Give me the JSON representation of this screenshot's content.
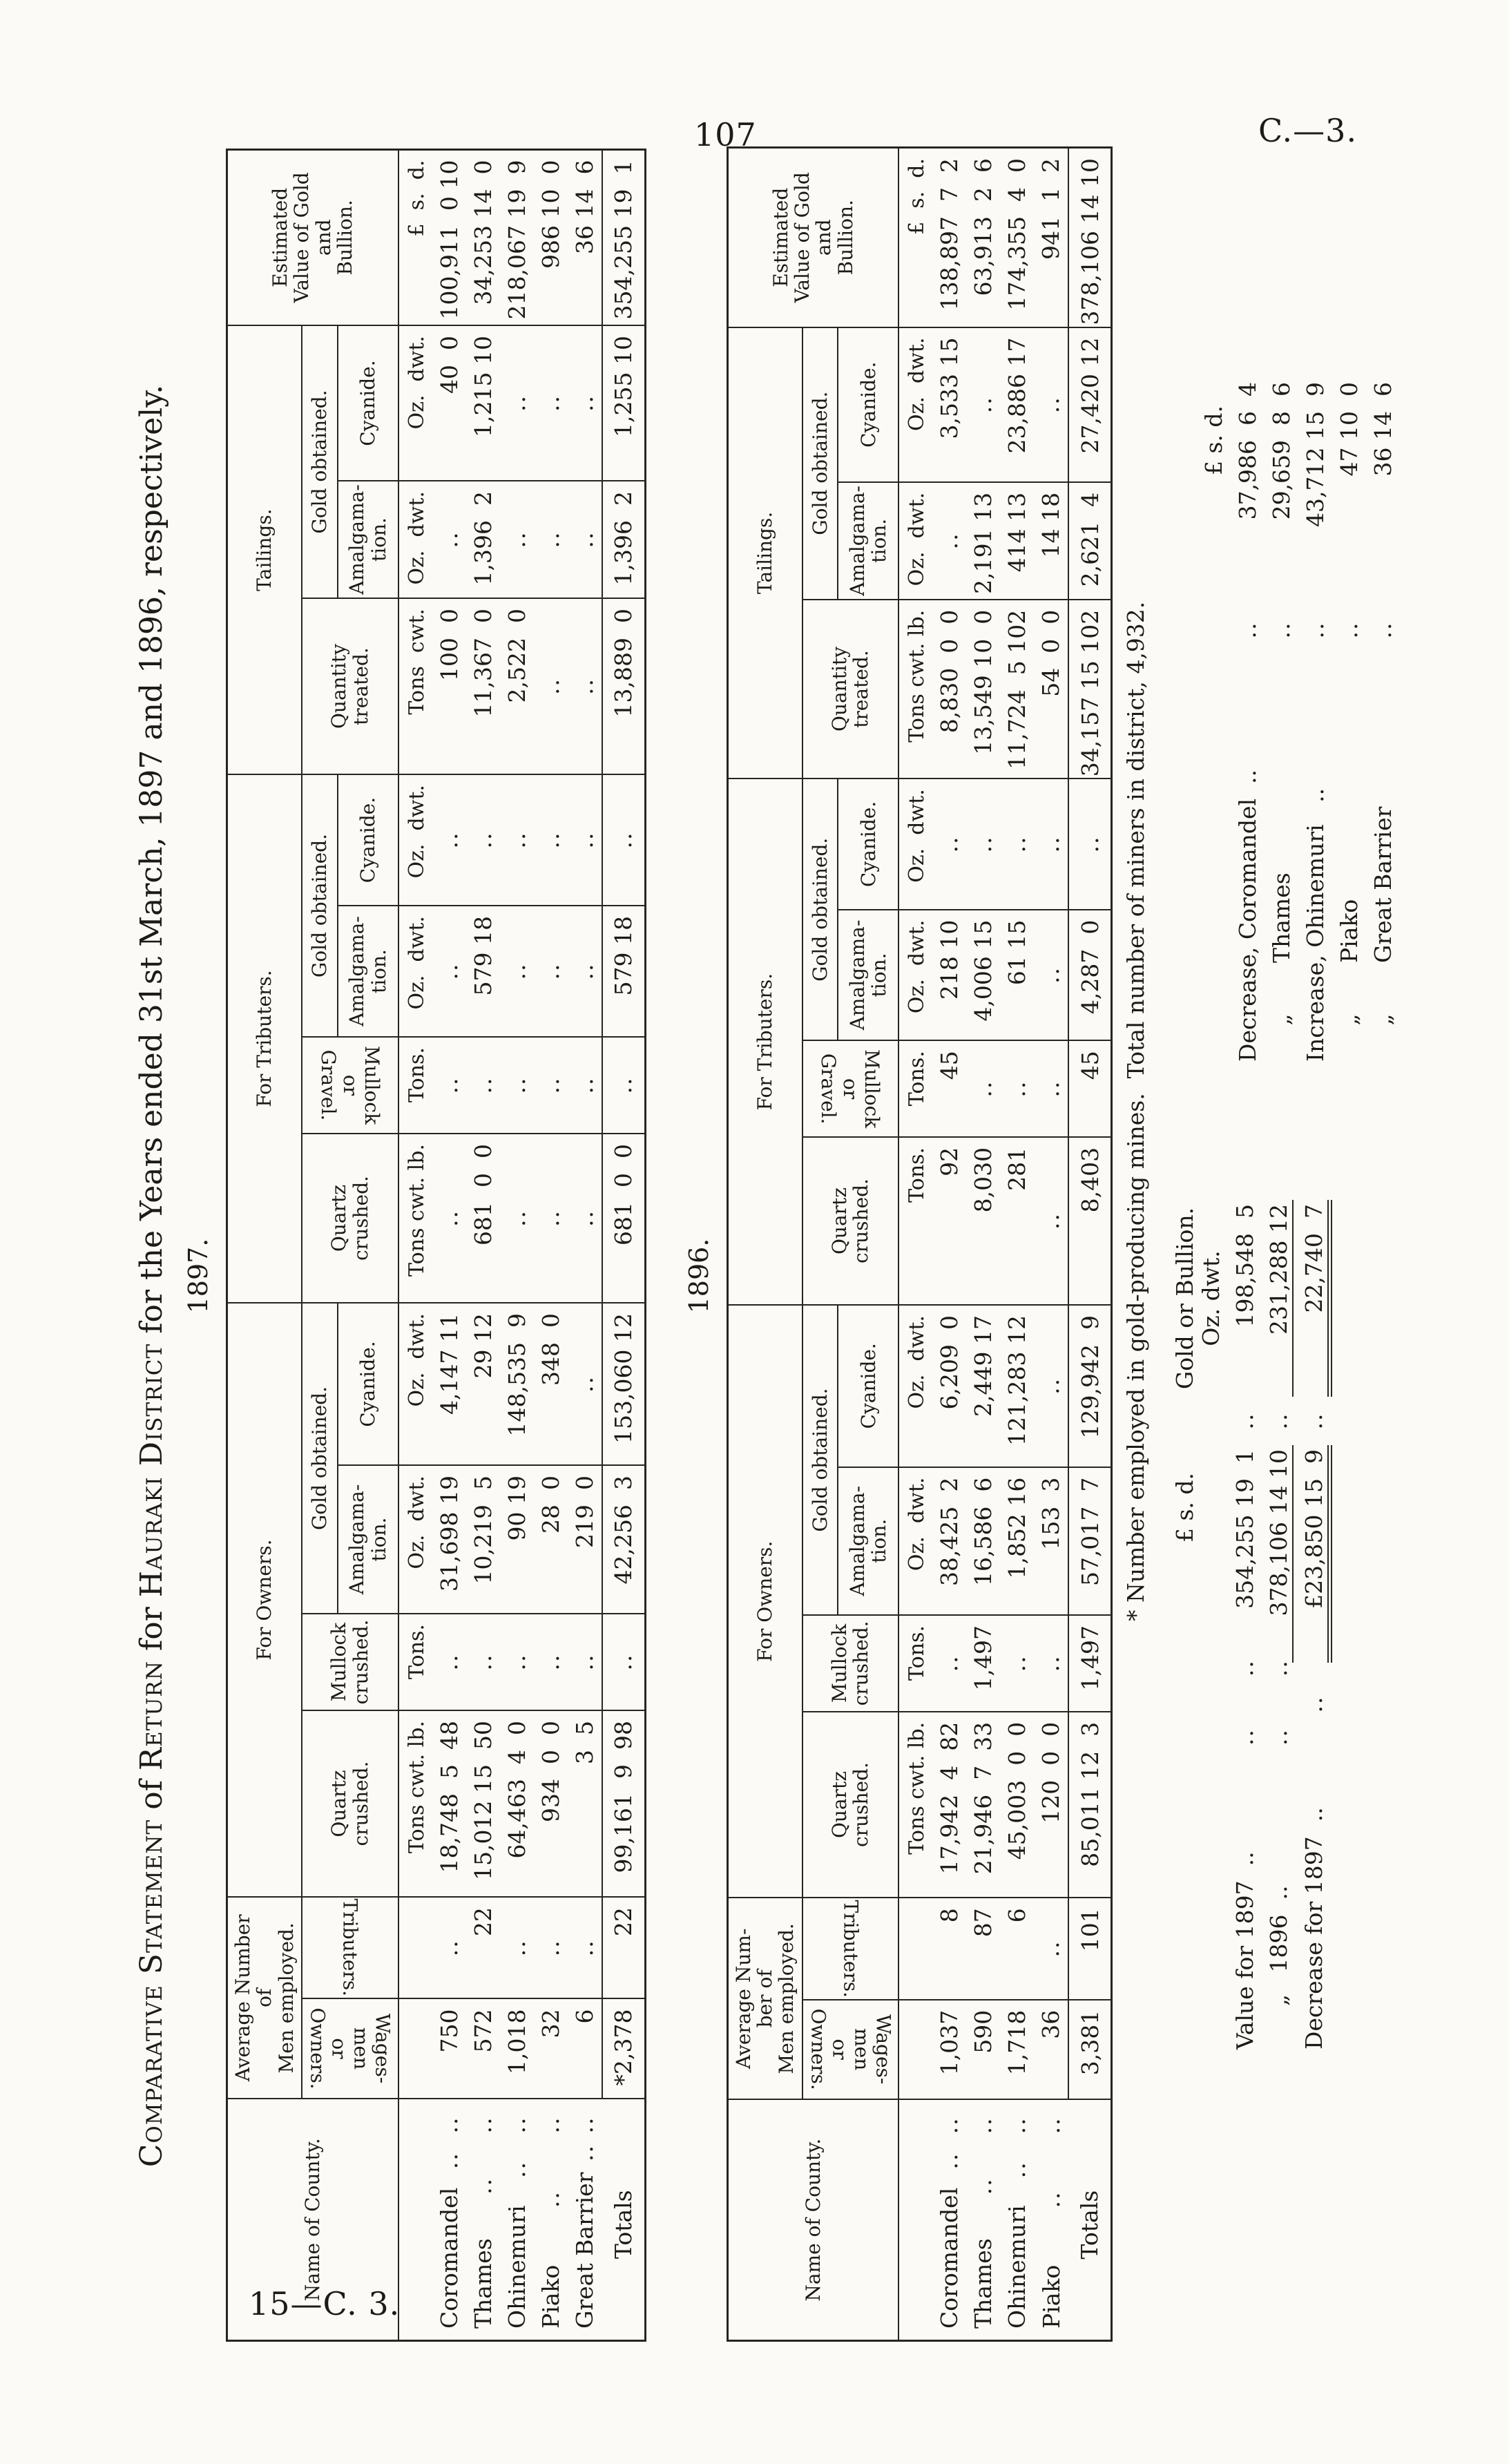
{
  "page": {
    "number": "107",
    "doc_code": "C.—3.",
    "sheet_code": "15—C. 3."
  },
  "title": {
    "p1": "Comparative Statement",
    "p2": " of ",
    "p3": "Return",
    "p4": " for ",
    "p5": "Hauraki District",
    "p6": " for the Years ended 31st March, 1897 and 1896, respectively."
  },
  "table_headers": {
    "name": "Name of County.",
    "wages": "Wages-men\nor Owners.",
    "tributers": "Tributers.",
    "for_owners": "For Owners.",
    "for_tributers": "For Tributers.",
    "tailings": "Tailings.",
    "quartz": "Quartz\ncrushed.",
    "mullock": "Mullock\ncrushed.",
    "gravel": "Mullock or\nGravel.",
    "gold": "Gold obtained.",
    "amalgamation": "Amalgama-\ntion.",
    "cyanide": "Cyanide.",
    "quantity": "Quantity\ntreated.",
    "estimated": "Estimated\nValue of Gold\nand\nBullion."
  },
  "tables": [
    {
      "year": "1897.",
      "avg_header": "Average Number\nof\nMen employed.",
      "units": [
        "",
        "",
        "Tons cwt. lb.",
        "Tons.",
        "Oz.  dwt.",
        "Oz.  dwt.",
        "Tons cwt. lb.",
        "Tons.",
        "Oz.  dwt.",
        "Oz.  dwt.",
        "Tons  cwt.",
        "Oz.  dwt.",
        "Oz.  dwt.",
        "£  s.  d."
      ],
      "rows": [
        {
          "name": "Coromandel",
          "cells": [
            "750",
            "..",
            "18,748  5  48",
            "..",
            "31,698 19",
            "4,147 11",
            "..",
            "..",
            "..",
            "..",
            "100  0",
            "..",
            "40  0",
            "100,911  0 10"
          ]
        },
        {
          "name": "Thames",
          "cells": [
            "572",
            "22",
            "15,012 15  50",
            "..",
            "10,219  5",
            "29 12",
            "681  0  0",
            "..",
            "579 18",
            "..",
            "11,367  0",
            "1,396  2",
            "1,215 10",
            "34,253 14  0"
          ]
        },
        {
          "name": "Ohinemuri",
          "cells": [
            "1,018",
            "..",
            "64,463  4  0",
            "..",
            "90 19",
            "148,535  9",
            "..",
            "..",
            "..",
            "..",
            "2,522  0",
            "..",
            "..",
            "218,067 19  9"
          ]
        },
        {
          "name": "Piako",
          "cells": [
            "32",
            "..",
            "934  0  0",
            "..",
            "28  0",
            "348  0",
            "..",
            "..",
            "..",
            "..",
            "..",
            "..",
            "..",
            "986 10  0"
          ]
        },
        {
          "name": "Great Barrier",
          "cells": [
            "6",
            "..",
            "3  5",
            "..",
            "219  0",
            "..",
            "..",
            "..",
            "..",
            "..",
            "..",
            "..",
            "..",
            "36 14  6"
          ]
        }
      ],
      "totals": {
        "label": "Totals",
        "cells": [
          "*2,378",
          "22",
          "99,161  9  98",
          "..",
          "42,256  3",
          "153,060 12",
          "681  0  0",
          "..",
          "579 18",
          "..",
          "13,889  0",
          "1,396  2",
          "1,255 10",
          "354,255 19  1"
        ]
      }
    },
    {
      "year": "1896.",
      "avg_header": "Average Num-\nber of\nMen employed.",
      "units": [
        "",
        "",
        "Tons cwt. lb.",
        "Tons.",
        "Oz.  dwt.",
        "Oz.  dwt.",
        "Tons.",
        "Tons.",
        "Oz.  dwt.",
        "Oz.  dwt.",
        "Tons cwt. lb.",
        "Oz.  dwt.",
        "Oz.  dwt.",
        "£  s.  d."
      ],
      "rows": [
        {
          "name": "Coromandel",
          "cells": [
            "1,037",
            "8",
            "17,942  4  82",
            "..",
            "38,425  2",
            "6,209  0",
            "92",
            "45",
            "218 10",
            "..",
            "8,830  0  0",
            "..",
            "3,533 15",
            "138,897  7  2"
          ]
        },
        {
          "name": "Thames",
          "cells": [
            "590",
            "87",
            "21,946  7  33",
            "1,497",
            "16,586  6",
            "2,449 17",
            "8,030",
            "..",
            "4,006 15",
            "..",
            "13,549 10  0",
            "2,191 13",
            "..",
            "63,913  2  6"
          ]
        },
        {
          "name": "Ohinemuri",
          "cells": [
            "1,718",
            "6",
            "45,003  0  0",
            "..",
            "1,852 16",
            "121,283 12",
            "281",
            "..",
            "61 15",
            "..",
            "11,724  5 102",
            "414 13",
            "23,886 17",
            "174,355  4  0"
          ]
        },
        {
          "name": "Piako",
          "cells": [
            "36",
            "..",
            "120  0  0",
            "..",
            "153  3",
            "..",
            "..",
            "..",
            "..",
            "..",
            "54  0  0",
            "14 18",
            "..",
            "941  1  2"
          ]
        }
      ],
      "totals": {
        "label": "Totals",
        "cells": [
          "3,381",
          "101",
          "85,011 12  3",
          "1,497",
          "57,017  7",
          "129,942  9",
          "8,403",
          "45",
          "4,287  0",
          "..",
          "34,157 15 102",
          "2,621  4",
          "27,420 12",
          "378,106 14 10"
        ]
      }
    }
  ],
  "footnote": "* Number employed in gold-producing mines.  Total number of miners in district, 4,932.",
  "value_summary": {
    "pounds_header": "£  s.  d.",
    "bullion_header": "Gold or Bullion.\nOz.   dwt.",
    "rows": [
      {
        "label": "Value for 1897  ..",
        "dots": "..      ..",
        "pounds": "354,255 19  1",
        "dots2": "..",
        "oz": "198,548  5",
        "rule": false,
        "final": false
      },
      {
        "label": "      „   1896  ..",
        "dots": "..      ..",
        "pounds": "378,106 14 10",
        "dots2": "..",
        "oz": "231,288 12",
        "rule": true,
        "final": false
      },
      {
        "label": "Decrease for 1897  ..",
        "dots": "..",
        "pounds": "£23,850 15  9",
        "dots2": "..",
        "oz": "22,740  7",
        "rule": false,
        "final": true
      }
    ]
  },
  "change_summary": {
    "pounds_header": "£  s.  d.",
    "rows": [
      {
        "label": "Decrease, Coromandel  ..",
        "dots": "..",
        "amount": "37,986  6  4"
      },
      {
        "label": "     „       Thames",
        "dots": "..",
        "amount": "29,659  8  6"
      },
      {
        "label": "Increase, Ohinemuri   ..",
        "dots": "..",
        "amount": "43,712 15  9"
      },
      {
        "label": "     „       Piako",
        "dots": "..",
        "amount": "47 10  0"
      },
      {
        "label": "     „       Great Barrier",
        "dots": "..",
        "amount": "36 14  6"
      }
    ]
  }
}
